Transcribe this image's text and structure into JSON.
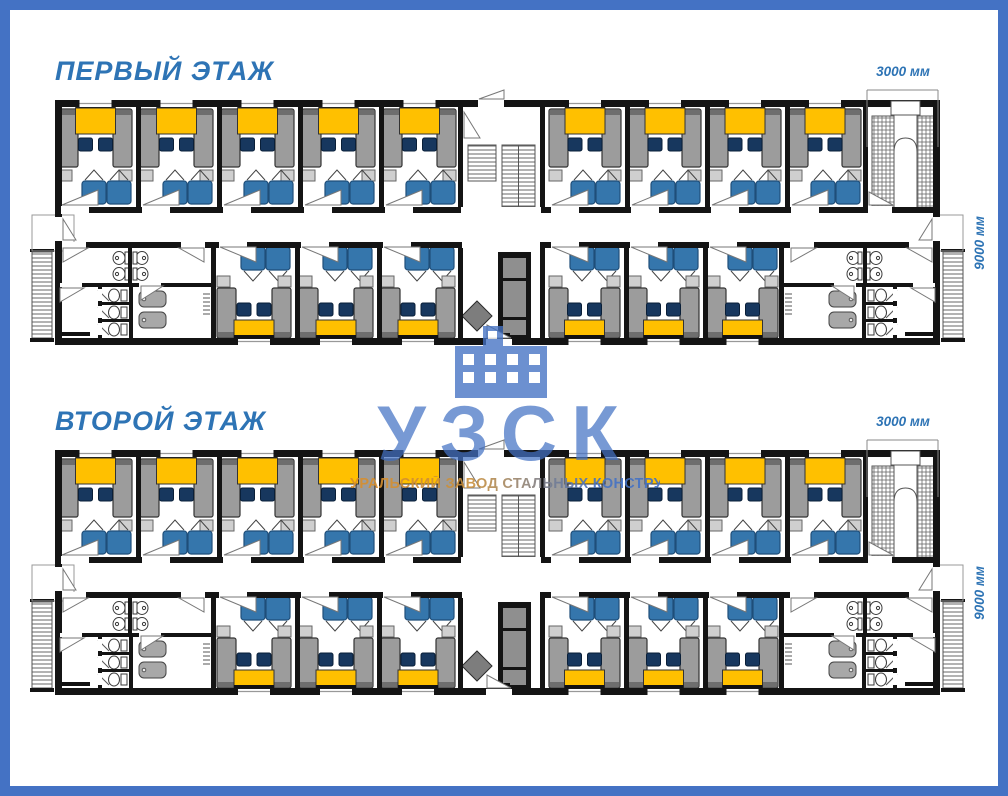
{
  "sheet": {
    "description": "Dormitory modular building floor plans"
  },
  "floors": [
    {
      "title": "ПЕРВЫЙ ЭТАЖ",
      "width_label": "3000 мм",
      "depth_label": "9000 мм"
    },
    {
      "title": "ВТОРОЙ ЭТАЖ",
      "width_label": "3000 мм",
      "depth_label": "9000 мм"
    }
  ],
  "watermark": {
    "abbr": "УЗСК",
    "subtitle": "УРАЛЬСКИЙ ЗАВОД СТАЛЬНЫХ КОНСТРУКЦИЙ",
    "icon": "building-icon"
  },
  "palette": {
    "frame": "#4472C4",
    "title_text": "#2E74B5",
    "wall": "#141414",
    "bed": "#9C9C9C",
    "bed_edge": "#333333",
    "pillow": "#6E6E6E",
    "table": "#FFC000",
    "chair": "#17375E",
    "wardrobe": "#3576AC",
    "wardrobe_edge": "#1F4E79",
    "nightstand": "#CFCFCF",
    "fixture_stroke": "#3A3A3A",
    "tub": "#A8A8A8",
    "cabinet": "#141414",
    "cabinet_panel": "#8F8F8F",
    "diamond": "#7D7D7D",
    "watermark_blue": "#4472C4",
    "watermark_orange": "#D98E2B"
  },
  "plan": {
    "floors_count": 2,
    "bedrooms_top_left": 5,
    "bedrooms_top_right": 4,
    "bedrooms_bottom_left": 3,
    "bedrooms_bottom_right": 3,
    "beds_per_bedroom": 2,
    "wardrobes_per_bedroom": 2,
    "chairs_per_bedroom": 2,
    "tables_per_bedroom": 1,
    "sanitary_blocks_per_floor": 2,
    "toilets_per_sanitary_block": 3,
    "showers_per_sanitary_block": 2,
    "sinks_per_sanitary_block": 4,
    "internal_staircases": 2,
    "external_staircases": 2
  }
}
